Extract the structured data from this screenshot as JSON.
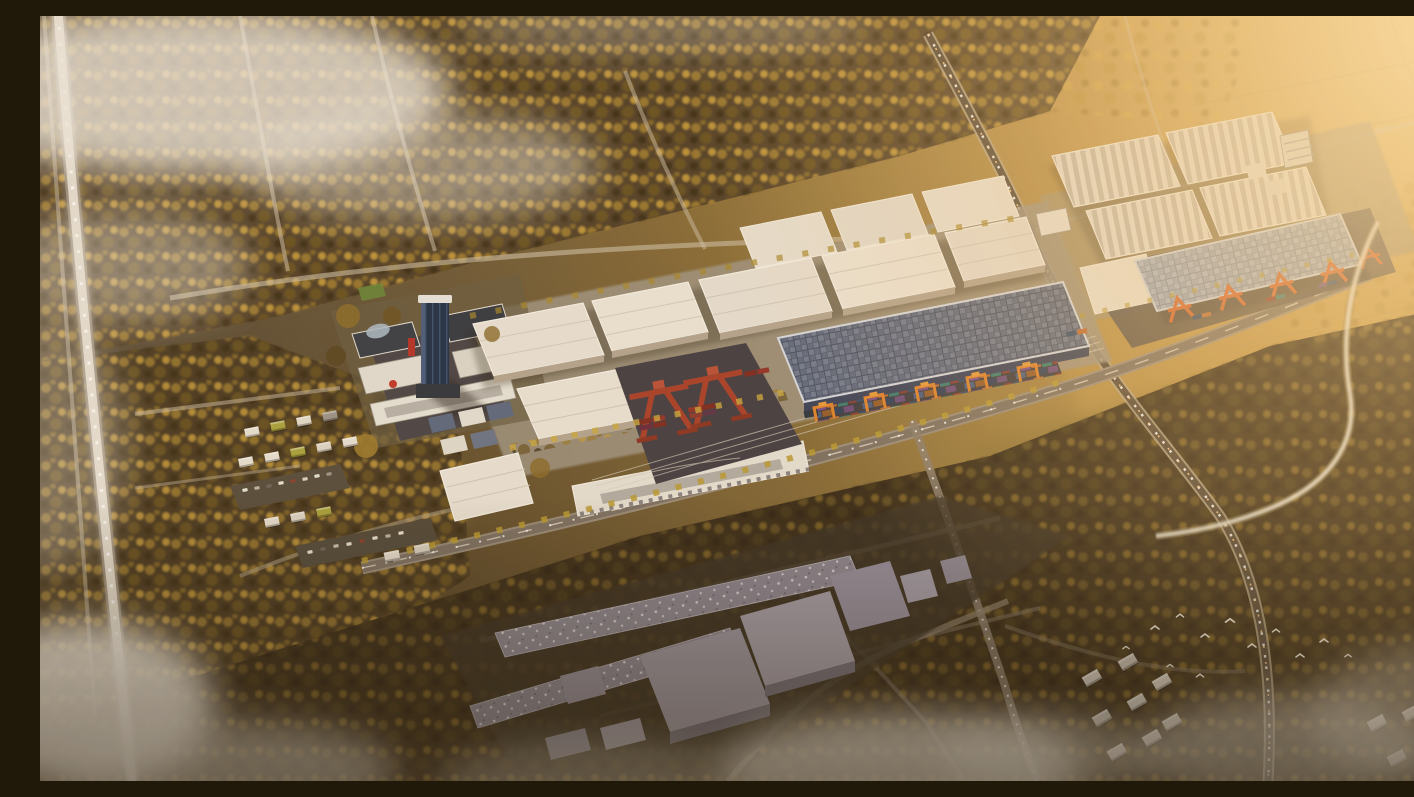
{
  "scene": {
    "title": "Golden-hour aerial rendering of a logistics industrial park with rail container terminals",
    "setting": "sunset aerial perspective, autumn woodland, low mist and clouds, no visible text",
    "labels": {
      "sky_glow": "Sunset glow",
      "forest": "Autumn woodland",
      "farmland": "Golden farmland",
      "highway": "Highway with traffic",
      "major_road": "Arterial road with traffic",
      "front_road": "Park frontage road",
      "minor_roads": "Minor roads",
      "park_ground": "Industrial park platform",
      "office_campus": "Office campus",
      "office_tower": "Glass office tower",
      "warehouses": "White logistics warehouses",
      "solar_warehouse": "Warehouse with rooftop solar array",
      "rail_yard": "Intermodal rail container yard",
      "red_cranes": "Red rail-mounted gantry cranes",
      "container_train": "Container train",
      "yellow_cranes": "Yellow gantry cranes",
      "factory_block": "Factory block with sawtooth roofs",
      "canopy_terminal": "Solar-canopy container terminal",
      "orange_cranes": "Orange gantry cranes",
      "stream": "Meandering stream",
      "village": "Village houses and parking",
      "context_buildings": "Untextured surrounding buildings",
      "suburb_houses": "Suburban houses",
      "birds": "Flock of white birds",
      "mist": "Low clouds and mist"
    },
    "palette": {
      "gold_light": "#ecc27d",
      "gold_mid": "#c1954d",
      "ground_dark": "#42331f",
      "tree_gold": "#c49a3c",
      "tree_dark": "#3e2f18",
      "roof_white": "#eae2d6",
      "roof_shade": "#b5a796",
      "solar_dark": "#616a82",
      "solar_light": "#9aa4b8",
      "tower_glass": "#223048",
      "crane_red": "#a8402c",
      "crane_orange": "#e0822c",
      "crane_deep_orange": "#d4622e",
      "container_blue": "#31496b",
      "asphalt": "#46404a",
      "road_light": "#cfc3ae",
      "mist_white": "#efe9e1"
    }
  }
}
